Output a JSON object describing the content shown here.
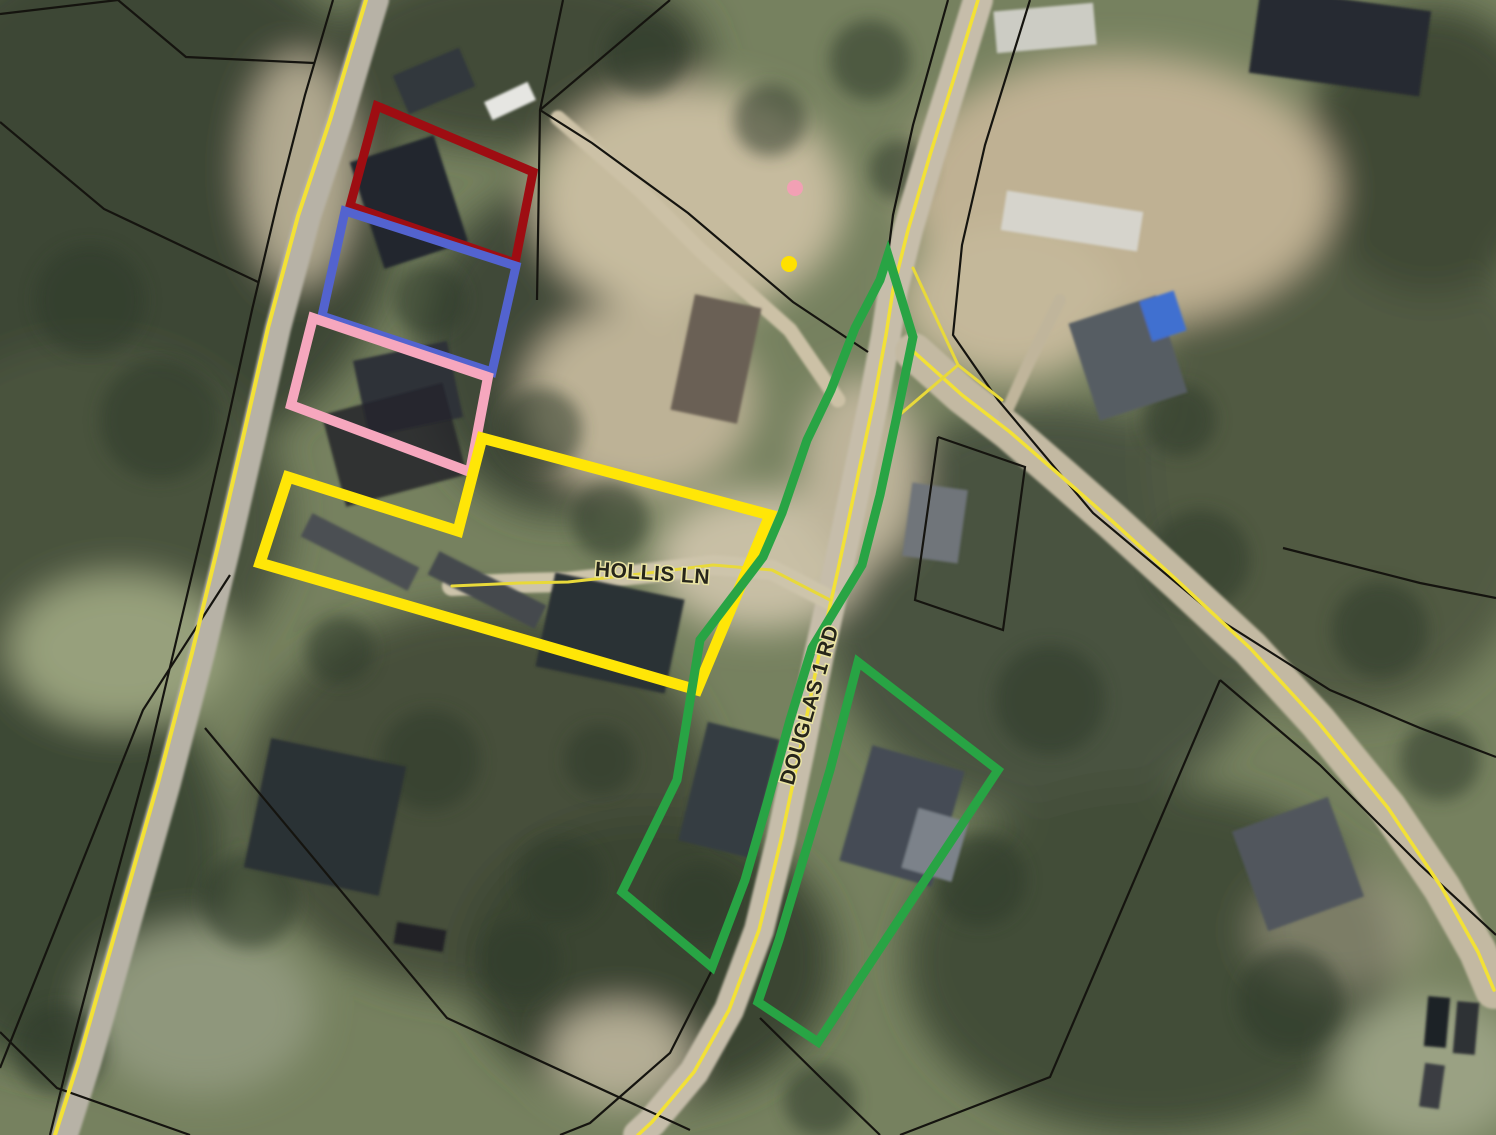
{
  "map": {
    "canvas": {
      "width": 1496,
      "height": 1135
    },
    "palette": {
      "boundary_black": "#15140f",
      "road_line_yellow": "#f2e136",
      "label_fill": "#26251a",
      "label_halo": "#e9e3a2",
      "parcel_red": "#9e0d12",
      "parcel_blue": "#5363cf",
      "parcel_pink": "#f6a7be",
      "parcel_yellow": "#ffe607",
      "parcel_green": "#28a444"
    },
    "road_labels": [
      {
        "id": "road-label-hollis-ln",
        "text": "HOLLIS LN",
        "x": 652,
        "y": 580,
        "rotation": 4,
        "font_size": 21
      },
      {
        "id": "road-label-douglas-1-rd",
        "text": "DOUGLAS 1 RD",
        "x": 816,
        "y": 707,
        "rotation": -74,
        "font_size": 21
      }
    ],
    "parcel_outlines": [
      {
        "id": "parcel-outline-dark-red",
        "color": "#9e0d12",
        "width": 9,
        "closed": true,
        "points": [
          [
            377,
            106
          ],
          [
            533,
            172
          ],
          [
            515,
            263
          ],
          [
            350,
            206
          ]
        ]
      },
      {
        "id": "parcel-outline-blue",
        "color": "#5363cf",
        "width": 9,
        "closed": true,
        "points": [
          [
            345,
            211
          ],
          [
            516,
            266
          ],
          [
            492,
            372
          ],
          [
            322,
            316
          ]
        ]
      },
      {
        "id": "parcel-outline-pink",
        "color": "#f6a7be",
        "width": 10,
        "closed": true,
        "points": [
          [
            313,
            318
          ],
          [
            488,
            377
          ],
          [
            470,
            472
          ],
          [
            291,
            405
          ]
        ]
      },
      {
        "id": "parcel-outline-yellow",
        "color": "#ffe607",
        "width": 11,
        "closed": true,
        "points": [
          [
            288,
            477
          ],
          [
            458,
            531
          ],
          [
            482,
            438
          ],
          [
            770,
            515
          ],
          [
            697,
            690
          ],
          [
            260,
            563
          ]
        ]
      },
      {
        "id": "parcel-outline-green-west",
        "color": "#28a444",
        "width": 9,
        "closed": true,
        "points": [
          [
            888,
            255
          ],
          [
            913,
            337
          ],
          [
            896,
            420
          ],
          [
            880,
            495
          ],
          [
            862,
            565
          ],
          [
            812,
            648
          ],
          [
            790,
            720
          ],
          [
            768,
            800
          ],
          [
            745,
            880
          ],
          [
            712,
            967
          ],
          [
            622,
            892
          ],
          [
            677,
            780
          ],
          [
            700,
            640
          ],
          [
            763,
            557
          ],
          [
            782,
            513
          ],
          [
            807,
            440
          ],
          [
            831,
            390
          ],
          [
            855,
            328
          ],
          [
            880,
            280
          ]
        ]
      },
      {
        "id": "parcel-outline-green-east",
        "color": "#28a444",
        "width": 9,
        "closed": true,
        "points": [
          [
            858,
            662
          ],
          [
            998,
            770
          ],
          [
            818,
            1042
          ],
          [
            758,
            1002
          ],
          [
            779,
            940
          ],
          [
            800,
            870
          ],
          [
            830,
            770
          ]
        ]
      }
    ],
    "point_markers": [
      {
        "id": "pink-point-marker",
        "color": "#f2a0b4",
        "x": 795,
        "y": 188,
        "r": 8
      },
      {
        "id": "yellow-point-marker",
        "color": "#ffe100",
        "x": 789,
        "y": 264,
        "r": 8
      }
    ],
    "road_lines": [
      {
        "id": "west-road-edge-line",
        "color": "#f2e136",
        "width": 4,
        "points": [
          [
            366,
            0
          ],
          [
            330,
            120
          ],
          [
            298,
            216
          ],
          [
            268,
            328
          ],
          [
            243,
            438
          ],
          [
            218,
            546
          ],
          [
            192,
            653
          ],
          [
            158,
            783
          ],
          [
            118,
            923
          ],
          [
            78,
            1063
          ],
          [
            55,
            1135
          ]
        ]
      },
      {
        "id": "douglas-1-rd-centerline",
        "color": "#f2e136",
        "width": 3.5,
        "points": [
          [
            978,
            0
          ],
          [
            955,
            75
          ],
          [
            930,
            155
          ],
          [
            908,
            230
          ],
          [
            893,
            290
          ],
          [
            886,
            335
          ],
          [
            874,
            400
          ],
          [
            857,
            480
          ],
          [
            838,
            570
          ],
          [
            820,
            650
          ],
          [
            800,
            750
          ],
          [
            781,
            840
          ],
          [
            759,
            930
          ],
          [
            729,
            1010
          ],
          [
            694,
            1072
          ],
          [
            652,
            1122
          ],
          [
            638,
            1135
          ]
        ]
      },
      {
        "id": "loop-road-centerline",
        "color": "#f2e136",
        "width": 3.5,
        "points": [
          [
            914,
            352
          ],
          [
            962,
            395
          ],
          [
            1010,
            432
          ],
          [
            1062,
            477
          ],
          [
            1112,
            521
          ],
          [
            1180,
            583
          ],
          [
            1250,
            648
          ],
          [
            1318,
            722
          ],
          [
            1388,
            808
          ],
          [
            1442,
            888
          ],
          [
            1478,
            952
          ],
          [
            1494,
            990
          ]
        ]
      },
      {
        "id": "hollis-ln-centerline",
        "color": "#e8d93a",
        "width": 3,
        "points": [
          [
            452,
            586
          ],
          [
            520,
            583
          ],
          [
            568,
            582
          ],
          [
            640,
            574
          ],
          [
            713,
            565
          ],
          [
            772,
            570
          ],
          [
            830,
            600
          ]
        ]
      },
      {
        "id": "road-fork-edge-a",
        "color": "#e8d93a",
        "width": 3,
        "points": [
          [
            913,
            268
          ],
          [
            958,
            365
          ],
          [
            1002,
            400
          ]
        ]
      },
      {
        "id": "road-fork-edge-b",
        "color": "#e8d93a",
        "width": 3,
        "points": [
          [
            958,
            365
          ],
          [
            897,
            417
          ]
        ]
      }
    ],
    "boundary_lines": [
      {
        "points": [
          [
            0,
            14
          ],
          [
            118,
            0
          ]
        ]
      },
      {
        "points": [
          [
            118,
            0
          ],
          [
            186,
            57
          ],
          [
            314,
            63
          ]
        ]
      },
      {
        "points": [
          [
            0,
            122
          ],
          [
            104,
            209
          ],
          [
            258,
            282
          ]
        ]
      },
      {
        "points": [
          [
            563,
            0
          ],
          [
            540,
            110
          ],
          [
            537,
            300
          ]
        ]
      },
      {
        "points": [
          [
            670,
            0
          ],
          [
            540,
            110
          ]
        ]
      },
      {
        "points": [
          [
            540,
            110
          ],
          [
            592,
            143
          ],
          [
            688,
            213
          ],
          [
            793,
            302
          ],
          [
            868,
            352
          ]
        ]
      },
      {
        "points": [
          [
            333,
            0
          ],
          [
            305,
            95
          ],
          [
            278,
            200
          ],
          [
            252,
            310
          ],
          [
            228,
            420
          ],
          [
            205,
            520
          ],
          [
            180,
            625
          ],
          [
            148,
            760
          ],
          [
            110,
            900
          ],
          [
            72,
            1045
          ],
          [
            50,
            1135
          ]
        ]
      },
      {
        "points": [
          [
            230,
            575
          ],
          [
            143,
            710
          ],
          [
            0,
            1068
          ]
        ]
      },
      {
        "points": [
          [
            205,
            728
          ],
          [
            447,
            1018
          ],
          [
            690,
            1130
          ]
        ]
      },
      {
        "points": [
          [
            0,
            1032
          ],
          [
            57,
            1088
          ],
          [
            190,
            1135
          ]
        ]
      },
      {
        "points": [
          [
            948,
            0
          ],
          [
            913,
            125
          ],
          [
            893,
            215
          ],
          [
            888,
            255
          ]
        ]
      },
      {
        "points": [
          [
            1030,
            0
          ],
          [
            985,
            145
          ],
          [
            962,
            245
          ],
          [
            953,
            335
          ],
          [
            998,
            400
          ],
          [
            1093,
            513
          ],
          [
            1223,
            622
          ],
          [
            1330,
            690
          ],
          [
            1420,
            728
          ],
          [
            1496,
            757
          ]
        ]
      },
      {
        "points": [
          [
            938,
            437
          ],
          [
            1025,
            467
          ],
          [
            1003,
            630
          ],
          [
            915,
            600
          ],
          [
            938,
            437
          ]
        ]
      },
      {
        "points": [
          [
            1283,
            548
          ],
          [
            1420,
            583
          ],
          [
            1496,
            598
          ]
        ]
      },
      {
        "points": [
          [
            900,
            1135
          ],
          [
            1050,
            1077
          ],
          [
            1220,
            680
          ]
        ]
      },
      {
        "points": [
          [
            1220,
            680
          ],
          [
            1320,
            765
          ],
          [
            1420,
            865
          ],
          [
            1496,
            935
          ]
        ]
      },
      {
        "points": [
          [
            712,
            970
          ],
          [
            670,
            1053
          ],
          [
            590,
            1123
          ],
          [
            560,
            1135
          ]
        ]
      },
      {
        "points": [
          [
            760,
            1018
          ],
          [
            823,
            1080
          ],
          [
            880,
            1135
          ]
        ]
      }
    ]
  }
}
